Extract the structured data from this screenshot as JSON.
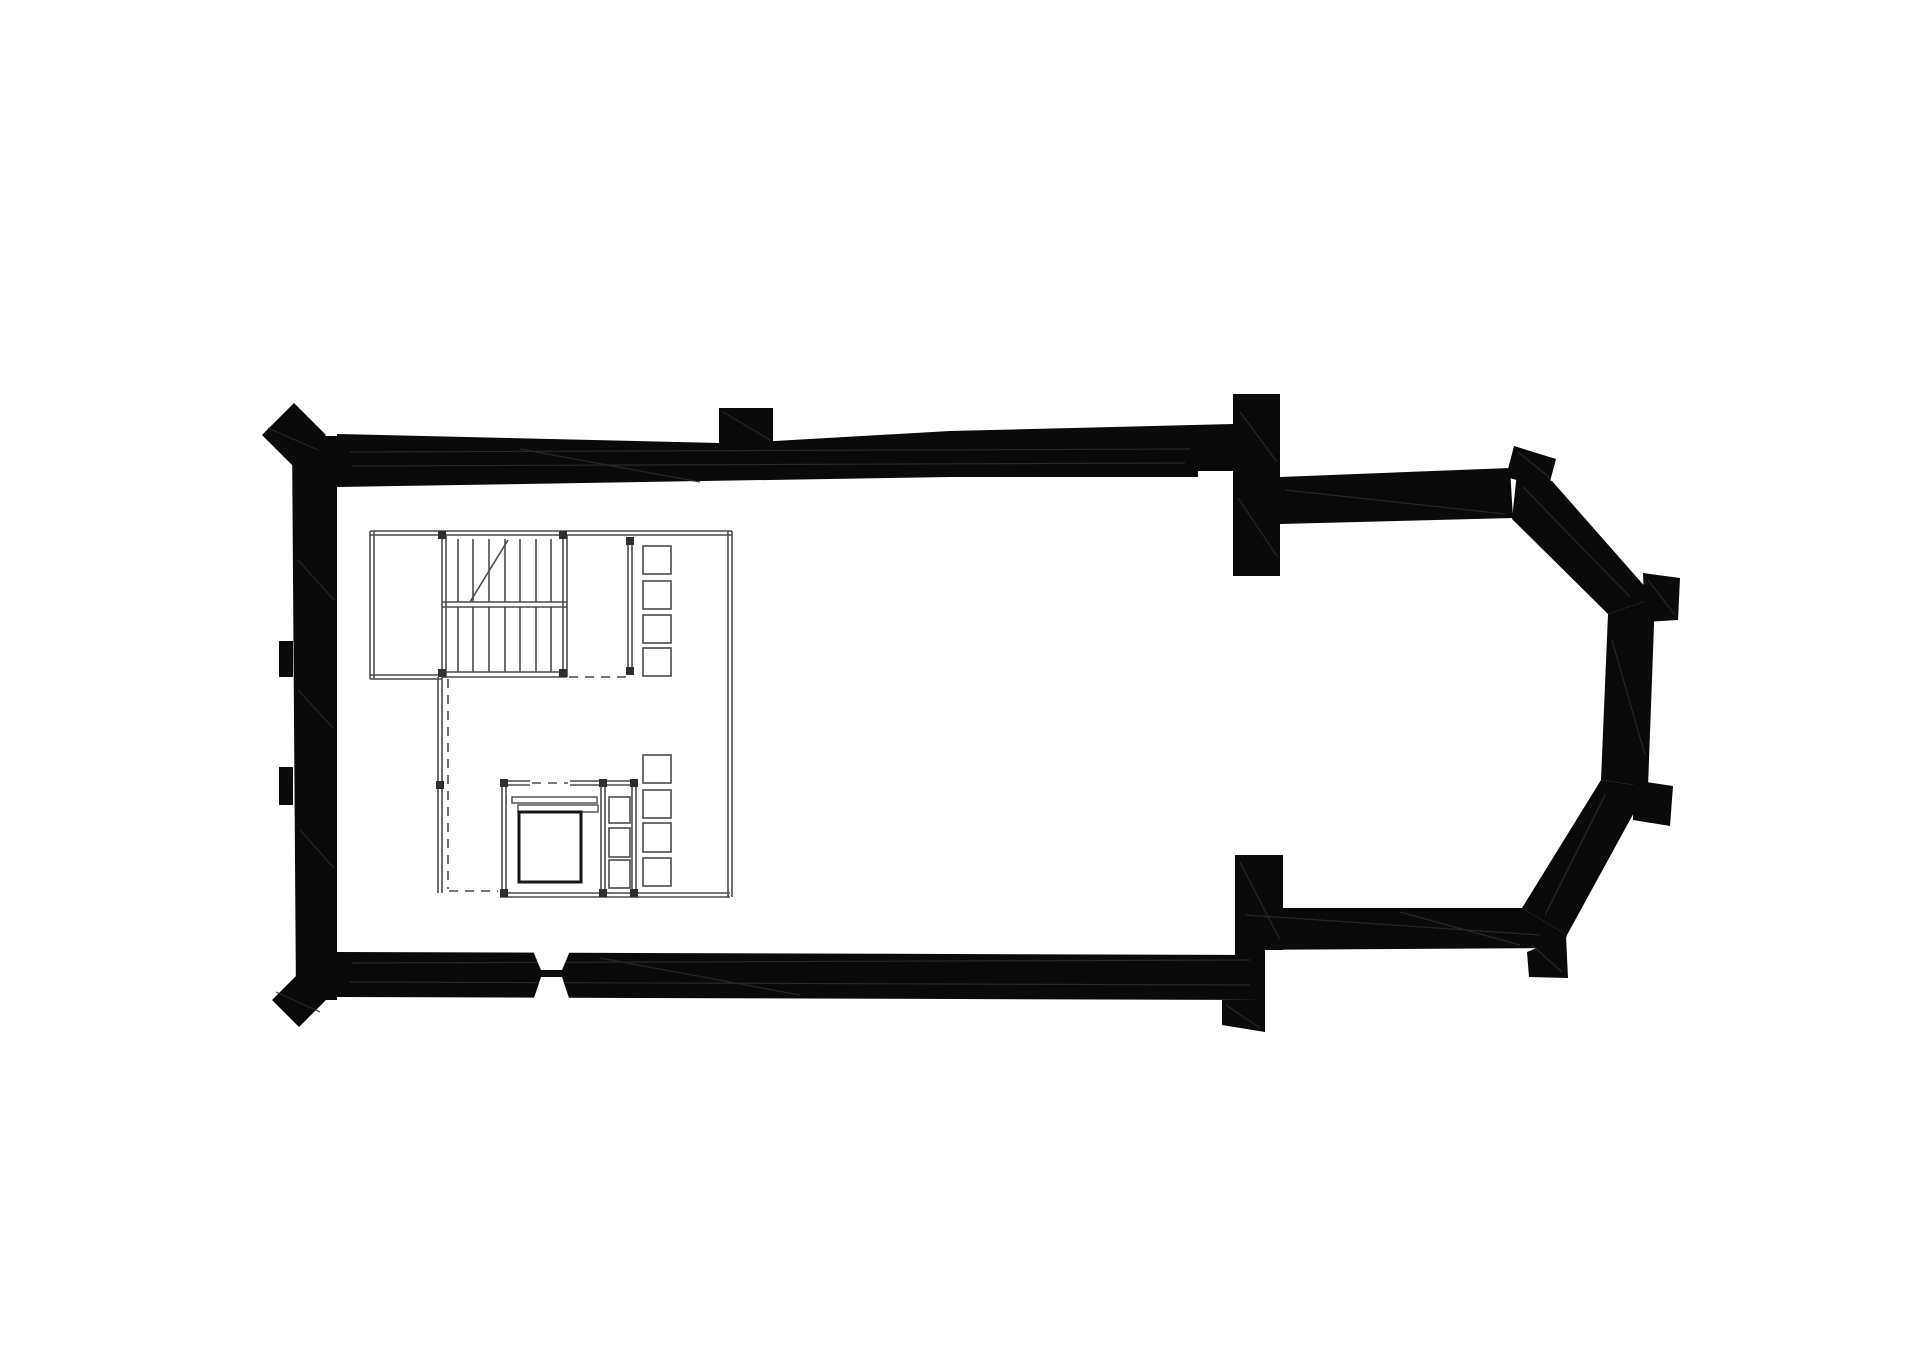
{
  "canvas": {
    "width": 1920,
    "height": 1358,
    "background": "#ffffff"
  },
  "palette": {
    "wall_fill": "#0a0a0a",
    "wall_streak": "#2b2b2b",
    "thin_line": "#4a4a4a",
    "heavy_line": "#161616",
    "post_fill": "#2e2e2e",
    "paper": "#ffffff"
  },
  "drawing": {
    "kind": "church-floor-plan",
    "walls": [
      {
        "name": "nave-west-wall",
        "points": [
          [
            292,
            436
          ],
          [
            337,
            436
          ],
          [
            337,
            1000
          ],
          [
            296,
            1000
          ]
        ]
      },
      {
        "name": "nave-north-wall",
        "points": [
          [
            337,
            434
          ],
          [
            720,
            443
          ],
          [
            775,
            441
          ],
          [
            950,
            431
          ],
          [
            1233,
            424
          ],
          [
            1233,
            471
          ],
          [
            1198,
            471
          ],
          [
            1198,
            477
          ],
          [
            950,
            477
          ],
          [
            337,
            487
          ]
        ]
      },
      {
        "name": "north-wall-stub-buttress",
        "points": [
          [
            719,
            408
          ],
          [
            773,
            408
          ],
          [
            773,
            445
          ],
          [
            719,
            445
          ]
        ]
      },
      {
        "name": "nw-corner-buttress",
        "points": [
          [
            294,
            403
          ],
          [
            326,
            435
          ],
          [
            294,
            467
          ],
          [
            262,
            435
          ]
        ]
      },
      {
        "name": "west-wall-pilaster-upper",
        "points": [
          [
            279,
            641
          ],
          [
            293,
            641
          ],
          [
            293,
            677
          ],
          [
            279,
            677
          ]
        ]
      },
      {
        "name": "west-wall-pilaster-lower",
        "points": [
          [
            279,
            767
          ],
          [
            293,
            767
          ],
          [
            293,
            805
          ],
          [
            279,
            805
          ]
        ]
      },
      {
        "name": "sw-corner-buttress",
        "points": [
          [
            299,
            973
          ],
          [
            326,
            1000
          ],
          [
            299,
            1027
          ],
          [
            272,
            1000
          ]
        ]
      },
      {
        "name": "nave-south-wall",
        "points": [
          [
            336,
            952
          ],
          [
            1265,
            955
          ],
          [
            1265,
            1000
          ],
          [
            336,
            997
          ]
        ]
      },
      {
        "name": "south-wall-stub-buttress",
        "points": [
          [
            1222,
            1000
          ],
          [
            1265,
            1000
          ],
          [
            1265,
            1032
          ],
          [
            1222,
            1025
          ]
        ]
      },
      {
        "name": "chancel-arch-north-respond",
        "points": [
          [
            1233,
            394
          ],
          [
            1280,
            394
          ],
          [
            1280,
            576
          ],
          [
            1233,
            576
          ]
        ]
      },
      {
        "name": "chancel-north-wall",
        "points": [
          [
            1280,
            477
          ],
          [
            1510,
            468
          ],
          [
            1513,
            518
          ],
          [
            1280,
            524
          ]
        ]
      },
      {
        "name": "apse-ne-corner-buttress",
        "points": [
          [
            1514,
            446
          ],
          [
            1556,
            459
          ],
          [
            1548,
            489
          ],
          [
            1506,
            477
          ]
        ]
      },
      {
        "name": "apse-northeast-wall",
        "points": [
          [
            1517,
            473
          ],
          [
            1552,
            481
          ],
          [
            1655,
            598
          ],
          [
            1608,
            614
          ],
          [
            1512,
            519
          ]
        ]
      },
      {
        "name": "apse-east-wall",
        "points": [
          [
            1608,
            614
          ],
          [
            1655,
            598
          ],
          [
            1648,
            787
          ],
          [
            1601,
            780
          ]
        ]
      },
      {
        "name": "apse-east-buttress-north",
        "points": [
          [
            1643,
            573
          ],
          [
            1680,
            578
          ],
          [
            1678,
            620
          ],
          [
            1645,
            622
          ]
        ]
      },
      {
        "name": "apse-east-buttress-south",
        "points": [
          [
            1633,
            780
          ],
          [
            1673,
            786
          ],
          [
            1670,
            826
          ],
          [
            1633,
            820
          ]
        ]
      },
      {
        "name": "apse-southeast-wall",
        "points": [
          [
            1601,
            780
          ],
          [
            1648,
            787
          ],
          [
            1567,
            935
          ],
          [
            1522,
            908
          ]
        ]
      },
      {
        "name": "apse-se-corner-buttress",
        "points": [
          [
            1527,
            952
          ],
          [
            1566,
            936
          ],
          [
            1568,
            978
          ],
          [
            1529,
            977
          ]
        ]
      },
      {
        "name": "chancel-south-wall",
        "points": [
          [
            1235,
            908
          ],
          [
            1522,
            908
          ],
          [
            1567,
            935
          ],
          [
            1563,
            948
          ],
          [
            1235,
            950
          ]
        ]
      },
      {
        "name": "chancel-arch-south-respond",
        "points": [
          [
            1235,
            855
          ],
          [
            1283,
            855
          ],
          [
            1283,
            950
          ],
          [
            1235,
            950
          ]
        ]
      },
      {
        "name": "south-junction-fill",
        "points": [
          [
            1235,
            950
          ],
          [
            1265,
            950
          ],
          [
            1265,
            955
          ],
          [
            1235,
            955
          ]
        ]
      }
    ],
    "wall_streaks": [
      [
        350,
        452,
        1190,
        449
      ],
      [
        352,
        466,
        1185,
        463
      ],
      [
        520,
        449,
        700,
        482
      ],
      [
        298,
        560,
        334,
        600
      ],
      [
        298,
        690,
        333,
        728
      ],
      [
        300,
        830,
        334,
        868
      ],
      [
        352,
        963,
        1250,
        960
      ],
      [
        350,
        982,
        1250,
        985
      ],
      [
        600,
        958,
        800,
        995
      ],
      [
        1240,
        412,
        1277,
        462
      ],
      [
        1238,
        498,
        1277,
        556
      ],
      [
        1285,
        490,
        1505,
        514
      ],
      [
        1523,
        487,
        1630,
        597
      ],
      [
        1612,
        640,
        1645,
        755
      ],
      [
        1605,
        795,
        1545,
        915
      ],
      [
        1245,
        915,
        1540,
        935
      ],
      [
        1400,
        912,
        1520,
        945
      ],
      [
        1240,
        862,
        1280,
        940
      ],
      [
        268,
        428,
        318,
        450
      ],
      [
        276,
        992,
        320,
        1012
      ],
      [
        723,
        412,
        770,
        440
      ],
      [
        1518,
        452,
        1550,
        478
      ],
      [
        1648,
        580,
        1675,
        615
      ],
      [
        1532,
        945,
        1562,
        972
      ],
      [
        1226,
        1005,
        1260,
        1028
      ]
    ],
    "openings": [
      {
        "name": "south-doorway-splay-north",
        "points": [
          [
            533,
            951
          ],
          [
            570,
            951
          ],
          [
            562,
            970
          ],
          [
            541,
            970
          ]
        ]
      },
      {
        "name": "south-doorway-splay-south",
        "points": [
          [
            541,
            977
          ],
          [
            562,
            977
          ],
          [
            570,
            1001
          ],
          [
            533,
            1001
          ]
        ]
      }
    ],
    "thin_lines": [
      [
        370,
        531,
        732,
        531
      ],
      [
        370,
        535,
        732,
        535
      ],
      [
        370,
        531,
        370,
        679
      ],
      [
        374,
        531,
        374,
        679
      ],
      [
        370,
        675,
        442,
        675
      ],
      [
        370,
        679,
        442,
        679
      ],
      [
        728,
        531,
        728,
        897
      ],
      [
        732,
        531,
        732,
        897
      ],
      [
        438,
        677,
        438,
        893
      ],
      [
        442,
        677,
        442,
        893
      ],
      [
        500,
        893,
        730,
        893
      ],
      [
        500,
        897,
        730,
        897
      ],
      [
        442,
        535,
        442,
        677
      ],
      [
        446,
        535,
        446,
        677
      ],
      [
        563,
        535,
        563,
        677
      ],
      [
        567,
        535,
        567,
        677
      ],
      [
        442,
        602,
        567,
        602
      ],
      [
        442,
        607,
        567,
        607
      ],
      [
        442,
        672,
        567,
        672
      ],
      [
        442,
        677,
        567,
        677
      ],
      [
        628,
        539,
        628,
        673
      ],
      [
        632,
        539,
        632,
        673
      ],
      [
        502,
        781,
        502,
        895
      ],
      [
        506,
        781,
        506,
        895
      ],
      [
        632,
        781,
        632,
        895
      ],
      [
        636,
        781,
        636,
        895
      ],
      [
        601,
        781,
        601,
        895
      ],
      [
        605,
        781,
        605,
        895
      ],
      [
        502,
        781,
        530,
        781
      ],
      [
        502,
        785,
        530,
        785
      ],
      [
        570,
        781,
        636,
        781
      ],
      [
        570,
        785,
        636,
        785
      ],
      [
        458,
        539,
        458,
        602
      ],
      [
        473,
        539,
        473,
        602
      ],
      [
        489,
        539,
        489,
        602
      ],
      [
        505,
        539,
        505,
        602
      ],
      [
        520,
        539,
        520,
        602
      ],
      [
        536,
        539,
        536,
        602
      ],
      [
        551,
        539,
        551,
        602
      ],
      [
        458,
        607,
        458,
        672
      ],
      [
        473,
        607,
        473,
        672
      ],
      [
        489,
        607,
        489,
        672
      ],
      [
        505,
        607,
        505,
        672
      ],
      [
        520,
        607,
        520,
        672
      ],
      [
        536,
        607,
        536,
        672
      ],
      [
        551,
        607,
        551,
        672
      ],
      [
        470,
        602,
        508,
        540
      ]
    ],
    "dashed_lines": [
      [
        448,
        679,
        448,
        889
      ],
      [
        569,
        677,
        628,
        677
      ],
      [
        449,
        891,
        498,
        891
      ],
      [
        532,
        783,
        568,
        783
      ]
    ],
    "furniture_squares": [
      {
        "name": "gallery-seat-square",
        "x": 643,
        "y": 546,
        "w": 28,
        "h": 28
      },
      {
        "name": "gallery-seat-square",
        "x": 643,
        "y": 581,
        "w": 28,
        "h": 28
      },
      {
        "name": "gallery-seat-square",
        "x": 643,
        "y": 615,
        "w": 28,
        "h": 28
      },
      {
        "name": "gallery-seat-square",
        "x": 643,
        "y": 648,
        "w": 28,
        "h": 28
      },
      {
        "name": "gallery-seat-square",
        "x": 643,
        "y": 755,
        "w": 28,
        "h": 28
      },
      {
        "name": "gallery-seat-square",
        "x": 643,
        "y": 790,
        "w": 28,
        "h": 28
      },
      {
        "name": "gallery-seat-square",
        "x": 643,
        "y": 823,
        "w": 28,
        "h": 29
      },
      {
        "name": "gallery-seat-square",
        "x": 643,
        "y": 858,
        "w": 28,
        "h": 28
      },
      {
        "name": "enclosure-step-square",
        "x": 609,
        "y": 797,
        "w": 21,
        "h": 26
      },
      {
        "name": "enclosure-step-square",
        "x": 609,
        "y": 828,
        "w": 21,
        "h": 29
      },
      {
        "name": "enclosure-step-square",
        "x": 609,
        "y": 860,
        "w": 21,
        "h": 28
      }
    ],
    "bench_bars": [
      {
        "name": "bench-bar-upper",
        "x": 512,
        "y": 797,
        "w": 85,
        "h": 6
      },
      {
        "name": "bench-bar-lower",
        "x": 518,
        "y": 805,
        "w": 80,
        "h": 7
      }
    ],
    "altar_square": {
      "name": "altar-square",
      "x": 519,
      "y": 812,
      "w": 62,
      "h": 70
    },
    "posts": [
      [
        442,
        535
      ],
      [
        563,
        535
      ],
      [
        442,
        673
      ],
      [
        563,
        673
      ],
      [
        630,
        541
      ],
      [
        630,
        671
      ],
      [
        504,
        783
      ],
      [
        603,
        783
      ],
      [
        504,
        893
      ],
      [
        603,
        893
      ],
      [
        634,
        783
      ],
      [
        634,
        893
      ],
      [
        440,
        785
      ]
    ]
  }
}
